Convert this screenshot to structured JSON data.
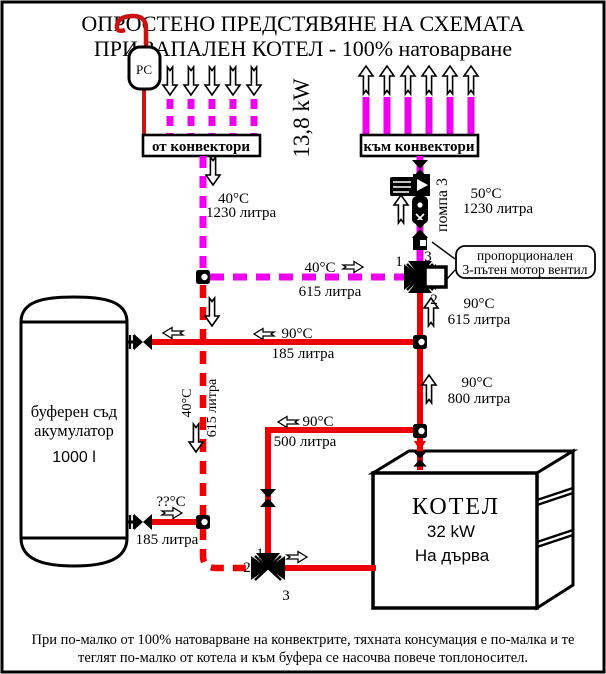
{
  "title": {
    "line1": "ОПРОСТЕНО ПРЕДСТЯВЯНЕ НА СХЕМАТА",
    "line2": "ПРИ ЗАПАЛЕН КОТЕЛ - 100% натоварване"
  },
  "vessel": {
    "label": "РС"
  },
  "convectors": {
    "from": "от конвектори",
    "to": "към конвектори",
    "power": "13,8 kW"
  },
  "pump": {
    "label": "помпа 3"
  },
  "motor_valve": {
    "note_line1": "пропорционален",
    "note_line2": "3-пътен мотор вентил"
  },
  "ports": {
    "p1": "1",
    "p2": "2",
    "p3": "3"
  },
  "tank": {
    "line1": "буферен съд",
    "line2": "акумулатор",
    "capacity": "1000 l"
  },
  "boiler": {
    "name": "КОТЕЛ",
    "power": "32 kW",
    "fuel": "На дърва"
  },
  "flows": {
    "return_from_convectors": {
      "temp": "40°C",
      "volume": "1230 литра"
    },
    "supply_to_convectors": {
      "temp": "50°C",
      "volume": "1230 литра"
    },
    "mix_branch": {
      "temp": "40°C",
      "volume": "615 литра"
    },
    "valve_outlet": {
      "temp": "90°C",
      "volume": "615 литра"
    },
    "tank_top": {
      "temp": "90°C",
      "volume": "185 литра"
    },
    "riser": {
      "temp": "90°C",
      "volume": "800 литра"
    },
    "boiler_supply": {
      "temp": "90°C",
      "volume": "500 литра"
    },
    "tank_bottom": {
      "temp": "??°C",
      "volume": "185 литра"
    },
    "return_drop": {
      "temp": "40°C",
      "volume": "615 литра"
    }
  },
  "caption": {
    "line1": "При по-малко от 100% натоварване на конвектрите, тяхната консумация е по-малка и те",
    "line2": "теглят по-малко от котела и към буфера се насочва повече топлоносител."
  },
  "colors": {
    "hot": "#ee0000",
    "warm": "#ee00ee",
    "outline": "#000000"
  }
}
